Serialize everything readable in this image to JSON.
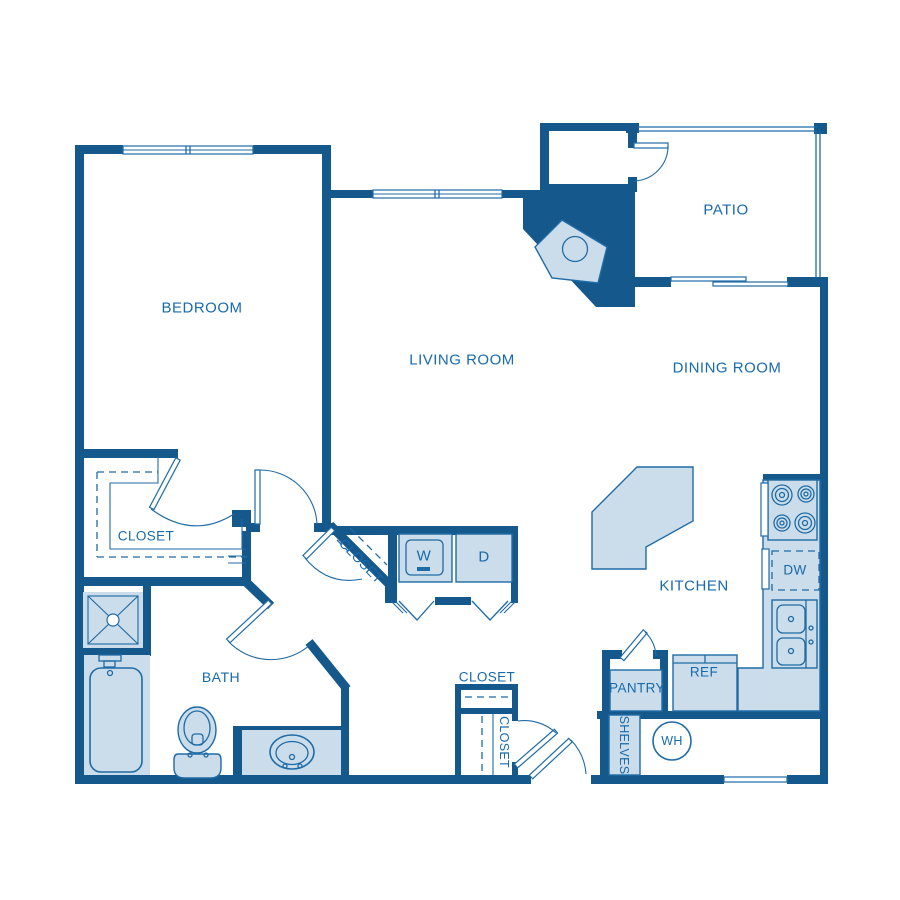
{
  "title": "Apartment floor plan",
  "colors": {
    "wall": "#15598c",
    "line": "#1f6ba6",
    "fill": "#cbdcea",
    "text": "#176aad",
    "bg": "#ffffff"
  },
  "rooms": {
    "bedroom": {
      "label": "BEDROOM"
    },
    "living_room": {
      "label": "LIVING ROOM"
    },
    "dining_room": {
      "label": "DINING ROOM"
    },
    "patio": {
      "label": "PATIO"
    },
    "kitchen": {
      "label": "KITCHEN"
    },
    "bath": {
      "label": "BATH"
    },
    "bedroom_closet": {
      "label": "CLOSET"
    },
    "hall_closet_angled": {
      "label": "CLOSET"
    },
    "hall_closet": {
      "label": "CLOSET"
    },
    "entry_closet": {
      "label": "CLOSET"
    },
    "pantry": {
      "label": "PANTRY"
    },
    "shelves": {
      "label": "SHELVES"
    }
  },
  "fixtures": {
    "washer": {
      "label": "W"
    },
    "dryer": {
      "label": "D"
    },
    "dishwasher": {
      "label": "DW"
    },
    "refrigerator": {
      "label": "REF"
    },
    "water_heater": {
      "label": "WH"
    }
  }
}
